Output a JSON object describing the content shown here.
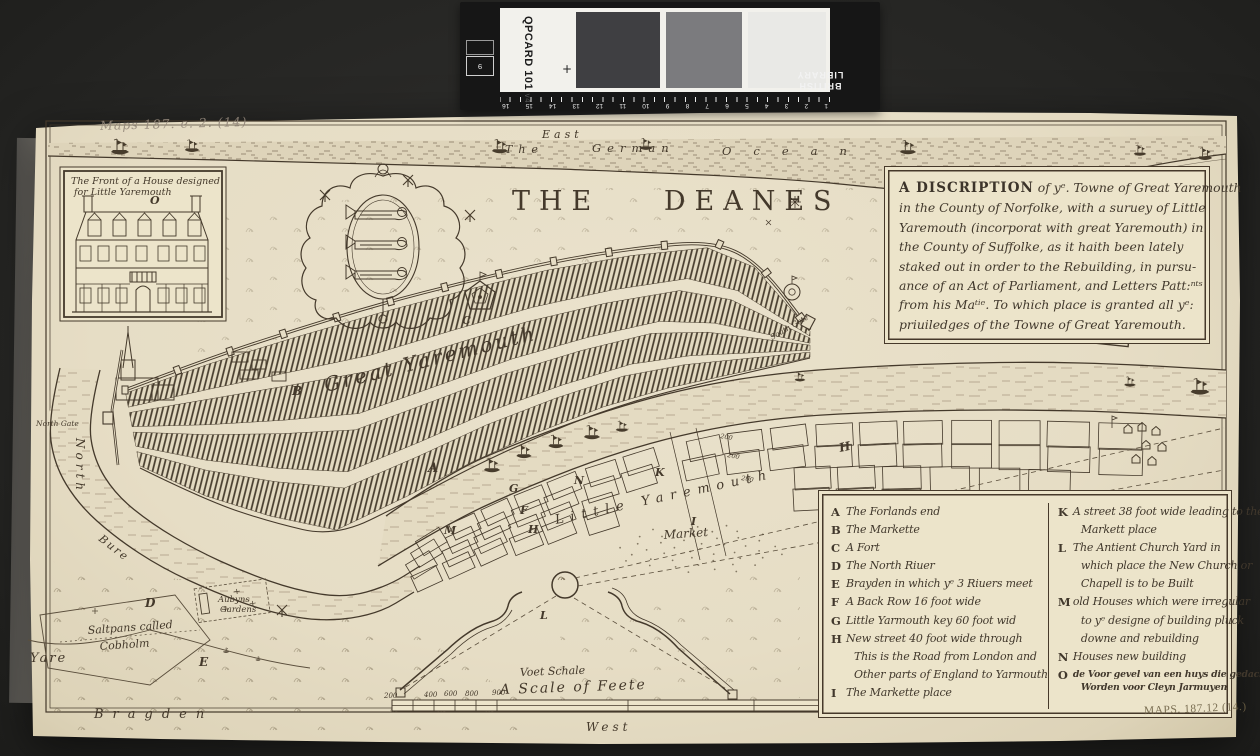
{
  "colors": {
    "paper": "#e8e0c9",
    "ink": "#44392b",
    "backdrop": "#262624"
  },
  "photo": {
    "pencil_note": "Maps 187. e. 2. (14)",
    "stamp": "MAPS. 187.12 (14.)"
  },
  "qp_card": {
    "brand": "QPCARD 101",
    "version": "v4",
    "corner_digit": "9",
    "institution_line1": "BRITISH",
    "institution_line2": "LIBRARY",
    "ruler_numbers": [
      "1",
      "2",
      "3",
      "4",
      "5",
      "6",
      "7",
      "8",
      "9",
      "10",
      "11",
      "12",
      "13",
      "14",
      "15",
      "16"
    ]
  },
  "map": {
    "title": "THE DEANES",
    "compass": {
      "east": "East",
      "west": "West",
      "north": "North"
    },
    "ocean": {
      "w1": "The",
      "w2": "German",
      "w3": "Ocean"
    },
    "labels": {
      "great_yarmouth": "Great Yaremouth",
      "little_yarmouth": "Little Yaremouth",
      "market": "Market",
      "bragden": "Bragden",
      "yare": "Yare",
      "bure": "Bure",
      "saltpans1": "Saltpans called",
      "saltpans2": "Cobholm",
      "gardens1": "Aubyns",
      "gardens2": "Gardens",
      "north_gate": "North Gate",
      "south_gate": "South Gate",
      "plot_depth": "200"
    },
    "letters": {
      "a": "A",
      "b": "B",
      "c": "C",
      "d": "D",
      "e": "E",
      "f": "F",
      "g": "G",
      "h": "H",
      "i": "I",
      "k": "K",
      "l": "L",
      "m": "M",
      "n": "N"
    },
    "inset": {
      "caption1": "The Front of a House designed",
      "caption2": "for Little Yaremouth",
      "letter": "O"
    },
    "scale": {
      "voet": "Voet Schale",
      "feete": "A Scale of Feete",
      "numbers": [
        "200",
        "400",
        "600",
        "800",
        "900"
      ]
    },
    "description": {
      "lead": "A DISCRIPTION",
      "line1rest": "of yᵉ. Towne of Great Yaremouth",
      "lines": [
        "in the County of Norfolke, with a suruey of Little",
        "Yaremouth (incorporat with great Yaremouth) in",
        "the County of Suffolke, as it haith been lately",
        "staked out in order to the Rebuilding, in pursu-",
        "ance of an Act of Parliament, and Letters Patt:ⁿᵗˢ",
        "from his Maᵗⁱᵉ. To which place is granted all yᵉ:",
        "priuiledges of the Towne of Great Yaremouth."
      ]
    },
    "legend": {
      "left": [
        {
          "key": "A",
          "lines": [
            "The Forlands end"
          ]
        },
        {
          "key": "B",
          "lines": [
            "The Markette"
          ]
        },
        {
          "key": "C",
          "lines": [
            "A Fort"
          ]
        },
        {
          "key": "D",
          "lines": [
            "The North Riuer"
          ]
        },
        {
          "key": "E",
          "lines": [
            "Brayden in which yᵉ 3 Riuers meet"
          ]
        },
        {
          "key": "F",
          "lines": [
            "A Back Row 16 foot wide"
          ]
        },
        {
          "key": "G",
          "lines": [
            "Little Yarmouth key 60 foot wid"
          ]
        },
        {
          "key": "H",
          "lines": [
            "New street 40 foot wide through",
            "This is the Road from London and",
            "Other parts of England to Yarmouth"
          ]
        },
        {
          "key": "I",
          "lines": [
            "The Markette place"
          ]
        }
      ],
      "right": [
        {
          "key": "K",
          "lines": [
            "A street 38 foot wide leading to the",
            "Markett place"
          ]
        },
        {
          "key": "L",
          "lines": [
            "The Antient Church Yard in",
            "which place the New Church or",
            "Chapell is to be Built"
          ]
        },
        {
          "key": "M",
          "lines": [
            "old Houses which were irregular",
            "to yᵉ designe of building pluck",
            "downe and rebuilding"
          ]
        },
        {
          "key": "N",
          "lines": [
            "Houses new building"
          ]
        },
        {
          "key": "O",
          "lines": [
            "de Voor gevel van een huys die gedacht",
            "Worden voor Cleyn Jarmuyen"
          ]
        }
      ]
    }
  }
}
